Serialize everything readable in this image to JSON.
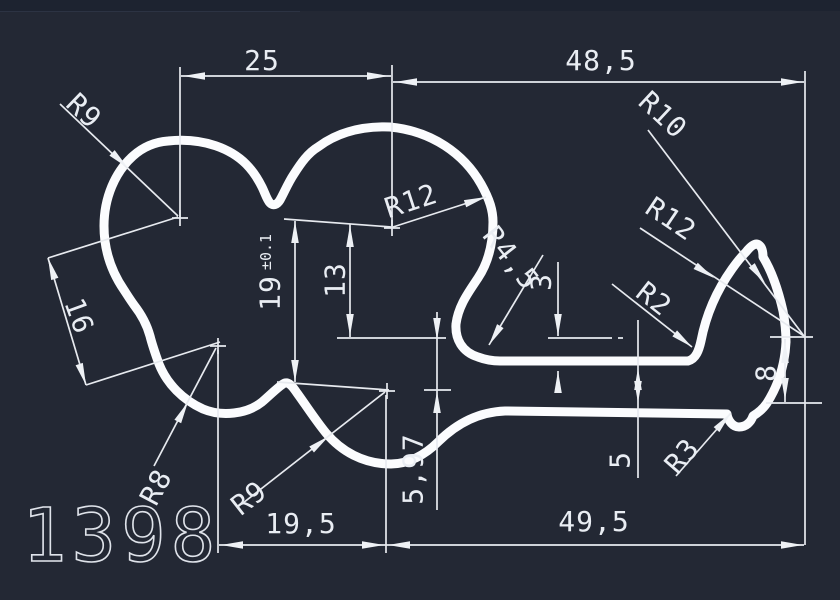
{
  "canvas": {
    "background_color": "#232834",
    "line_color": "#fbfcfe",
    "dim_color": "#e9edf3"
  },
  "drawing": {
    "part_number": "1398",
    "dimensions": {
      "top_left_width": "25",
      "top_right_width": "48,5",
      "bottom_left_width": "19,5",
      "bottom_right_width": "49,5",
      "overall_height": "19",
      "overall_height_tolerance": "±0.1",
      "inner_height": "13",
      "lobe_distance": "16",
      "lip_gap": "3",
      "arm_thickness": "5",
      "hook_height": "8",
      "foot_drop": "5,97"
    },
    "radii": {
      "top_left_lobe": "R9",
      "top_right_lobe": "R12",
      "hook_outer": "R10",
      "hook_face": "R12",
      "neck_fillet": "R4,5",
      "stem_corner": "R2",
      "foot_tip": "R3",
      "bottom_left_lobe": "R8",
      "bottom_right_lobe": "R9"
    }
  }
}
